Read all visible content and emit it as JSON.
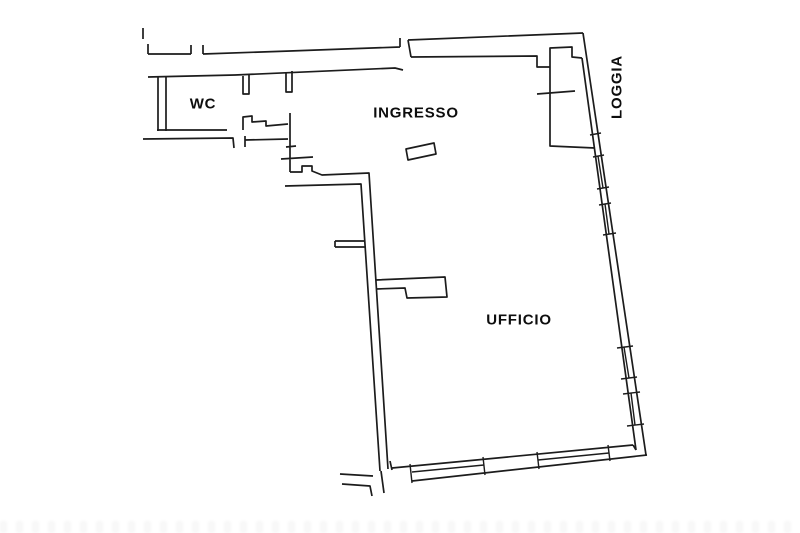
{
  "plan": {
    "title": "floor plan",
    "rooms": [
      {
        "id": "wc",
        "label": "WC"
      },
      {
        "id": "ingresso",
        "label": "INGRESSO"
      },
      {
        "id": "ufficio",
        "label": "UFFICIO"
      },
      {
        "id": "loggia",
        "label": "LOGGIA"
      }
    ],
    "colors": {
      "line": "#1c1c1c",
      "background": "#ffffff",
      "text": "#0d0d0d"
    }
  }
}
